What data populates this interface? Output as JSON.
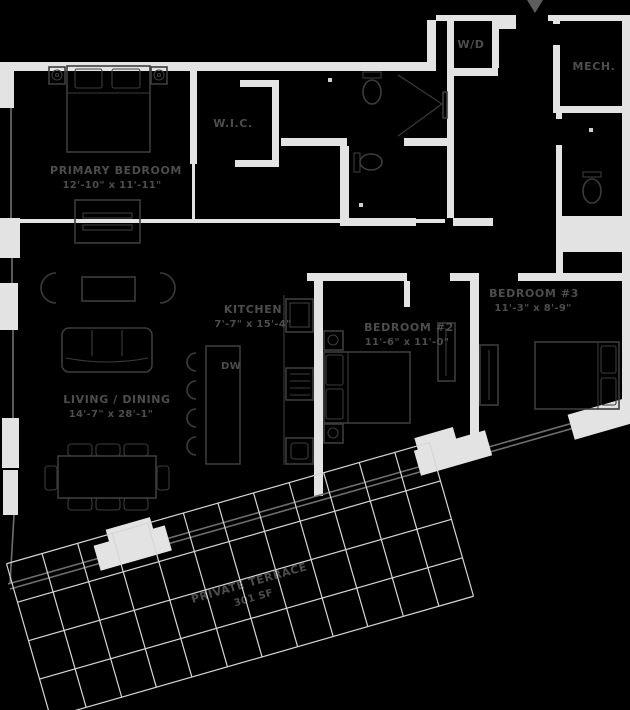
{
  "meta": {
    "type": "apartment-floor-plan",
    "width_px": 630,
    "height_px": 710
  },
  "colors": {
    "bg": "#000000",
    "wall": "#e3e3e3",
    "line": "#3c3c3c",
    "label": "#4d4d4d",
    "grid": "#d6d6d6",
    "window": "#6f6f6f",
    "arrow": "#5e5e5e"
  },
  "rooms": [
    {
      "id": "primary-bedroom",
      "name": "PRIMARY BEDROOM",
      "dims": "12'-10\" x 11'-11\""
    },
    {
      "id": "walk-in-closet",
      "name": "W.I.C."
    },
    {
      "id": "washer-dryer-closet",
      "name": "W/D"
    },
    {
      "id": "mechanical-room",
      "name": "MECH."
    },
    {
      "id": "kitchen",
      "name": "KITCHEN",
      "dims": "7'-7\" x 15'-4\""
    },
    {
      "id": "dishwasher",
      "name": "DW"
    },
    {
      "id": "bedroom-2",
      "name": "BEDROOM #2",
      "dims": "11'-6\" x 11'-0\""
    },
    {
      "id": "bedroom-3",
      "name": "BEDROOM #3",
      "dims": "11'-3\" x 8'-9\""
    },
    {
      "id": "living-dining",
      "name": "LIVING / DINING",
      "dims": "14'-7\" x 28'-1\""
    },
    {
      "id": "private-terrace",
      "name": "PRIVATE TERRACE",
      "area": "301 SF"
    }
  ]
}
